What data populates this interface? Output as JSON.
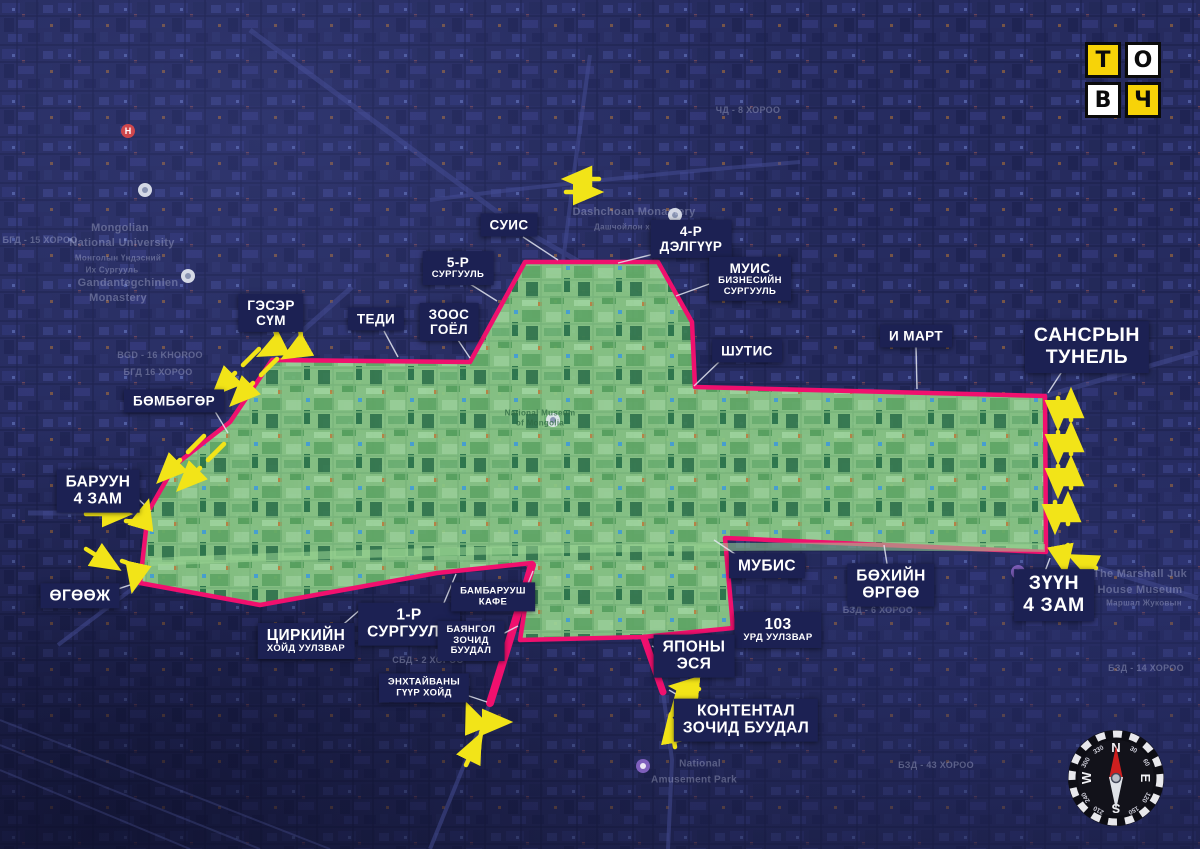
{
  "page": {
    "width": 1200,
    "height": 849,
    "kind": "annotated satellite map"
  },
  "colors": {
    "background": "#232858",
    "zone_fill": "#8ccb86",
    "zone_boundary": "#f0106e",
    "arrow_yellow": "#f2e418",
    "label_bg": "#1c2153",
    "label_text": "#ffffff",
    "logo_yellow": "#f7d308"
  },
  "logo": {
    "tiles": [
      {
        "ch": "Т",
        "bg": "#f7d308"
      },
      {
        "ch": "О",
        "bg": "#ffffff"
      },
      {
        "ch": "В",
        "bg": "#ffffff"
      },
      {
        "ch": "Ч",
        "bg": "#f7d308"
      }
    ]
  },
  "callouts": [
    {
      "id": "suis",
      "x": 509,
      "y": 225,
      "lines": [
        {
          "t": "СУИС",
          "s": "md"
        }
      ],
      "ptr": [
        523,
        237,
        558,
        260
      ]
    },
    {
      "id": "delguur-4",
      "x": 691,
      "y": 239,
      "lines": [
        {
          "t": "4-Р",
          "s": "md"
        },
        {
          "t": "ДЭЛГҮҮР",
          "s": "md"
        }
      ],
      "ptr": [
        662,
        252,
        618,
        263
      ]
    },
    {
      "id": "surguuli-5",
      "x": 458,
      "y": 268,
      "lines": [
        {
          "t": "5-Р",
          "s": "md"
        },
        {
          "t": "СУРГУУЛЬ",
          "s": "xxs"
        }
      ],
      "ptr": [
        470,
        284,
        497,
        301
      ]
    },
    {
      "id": "muis",
      "x": 750,
      "y": 279,
      "lines": [
        {
          "t": "МУИС",
          "s": "md"
        },
        {
          "t": "БИЗНЕСИЙН",
          "s": "xxs"
        },
        {
          "t": "СУРГУУЛЬ",
          "s": "xxs"
        }
      ],
      "ptr": [
        712,
        283,
        676,
        296
      ]
    },
    {
      "id": "zoos-goyol",
      "x": 449,
      "y": 322,
      "lines": [
        {
          "t": "ЗООС",
          "s": "md"
        },
        {
          "t": "ГОЁЛ",
          "s": "md"
        }
      ],
      "ptr": [
        458,
        340,
        470,
        358
      ]
    },
    {
      "id": "geser-sum",
      "x": 271,
      "y": 313,
      "lines": [
        {
          "t": "ГЭСЭР",
          "s": "md"
        },
        {
          "t": "СҮМ",
          "s": "md"
        }
      ],
      "ptr": [
        273,
        331,
        282,
        347
      ]
    },
    {
      "id": "tedi",
      "x": 376,
      "y": 319,
      "lines": [
        {
          "t": "ТЕДИ",
          "s": "md"
        }
      ],
      "ptr": [
        384,
        331,
        398,
        357
      ]
    },
    {
      "id": "shutis",
      "x": 747,
      "y": 351,
      "lines": [
        {
          "t": "ШУТИС",
          "s": "md"
        }
      ],
      "ptr": [
        720,
        361,
        694,
        386
      ]
    },
    {
      "id": "e-mart",
      "x": 916,
      "y": 336,
      "lines": [
        {
          "t": "И МАРТ",
          "s": "md"
        }
      ],
      "ptr": [
        916,
        347,
        917,
        389
      ]
    },
    {
      "id": "sansryn-tunel",
      "x": 1087,
      "y": 347,
      "lines": [
        {
          "t": "САНСРЫН",
          "s": "xl"
        },
        {
          "t": "ТУНЕЛЬ",
          "s": "xl"
        }
      ],
      "ptr": [
        1063,
        370,
        1048,
        393
      ]
    },
    {
      "id": "bombogor",
      "x": 174,
      "y": 401,
      "lines": [
        {
          "t": "БӨМБӨГӨР",
          "s": "md"
        }
      ],
      "ptr": [
        213,
        408,
        228,
        433
      ]
    },
    {
      "id": "baruun-4-zam",
      "x": 98,
      "y": 491,
      "lines": [
        {
          "t": "БАРУУН",
          "s": "lg"
        },
        {
          "t": "4 ЗАМ",
          "s": "lg"
        }
      ],
      "ptr": [
        134,
        495,
        151,
        511
      ]
    },
    {
      "id": "ogooj",
      "x": 80,
      "y": 596,
      "lines": [
        {
          "t": "ӨГӨӨЖ",
          "s": "lg"
        }
      ],
      "ptr": [
        103,
        594,
        136,
        583
      ]
    },
    {
      "id": "tsirkiin",
      "x": 306,
      "y": 641,
      "lines": [
        {
          "t": "ЦИРКИЙН",
          "s": "lg"
        },
        {
          "t": "ХОЙД УУЛЗВАР",
          "s": "xxs"
        }
      ],
      "ptr": [
        338,
        629,
        362,
        608
      ]
    },
    {
      "id": "surguuli-1",
      "x": 409,
      "y": 624,
      "lines": [
        {
          "t": "1-Р",
          "s": "lg"
        },
        {
          "t": "СУРГУУЛЬ",
          "s": "lg"
        }
      ],
      "ptr": [
        441,
        610,
        456,
        574
      ]
    },
    {
      "id": "bambaruush",
      "x": 493,
      "y": 597,
      "lines": [
        {
          "t": "БАМБАРУУШ",
          "s": "xxs"
        },
        {
          "t": "КАФЕ",
          "s": "xxs"
        }
      ],
      "ptr": [
        523,
        596,
        533,
        571
      ]
    },
    {
      "id": "bayangol",
      "x": 471,
      "y": 641,
      "lines": [
        {
          "t": "БАЯНГОЛ",
          "s": "xxs"
        },
        {
          "t": "ЗОЧИД",
          "s": "xxs"
        },
        {
          "t": "БУУДАЛ",
          "s": "xxs"
        }
      ],
      "ptr": [
        495,
        638,
        518,
        626
      ]
    },
    {
      "id": "enkhtaivany",
      "x": 424,
      "y": 688,
      "lines": [
        {
          "t": "ЭНХТАЙВАНЫ",
          "s": "xxs"
        },
        {
          "t": "ГҮҮР ХОЙД",
          "s": "xxs"
        }
      ],
      "ptr": [
        454,
        691,
        487,
        702
      ]
    },
    {
      "id": "mubis",
      "x": 767,
      "y": 566,
      "lines": [
        {
          "t": "МУБИС",
          "s": "lg"
        }
      ],
      "ptr": [
        741,
        558,
        714,
        540
      ]
    },
    {
      "id": "bokhiin-orgoo",
      "x": 891,
      "y": 585,
      "lines": [
        {
          "t": "БӨХИЙН",
          "s": "lg"
        },
        {
          "t": "ӨРГӨӨ",
          "s": "lg"
        }
      ],
      "ptr": [
        888,
        570,
        884,
        545
      ]
    },
    {
      "id": "urd-103",
      "x": 778,
      "y": 630,
      "lines": [
        {
          "t": "103",
          "s": "lg"
        },
        {
          "t": "УРД УУЛЗВАР",
          "s": "xxs"
        }
      ],
      "ptr": [
        752,
        629,
        736,
        629
      ]
    },
    {
      "id": "yapony-esya",
      "x": 694,
      "y": 656,
      "lines": [
        {
          "t": "ЯПОНЫ",
          "s": "lg"
        },
        {
          "t": "ЭСЯ",
          "s": "lg"
        }
      ],
      "ptr": [
        666,
        653,
        652,
        646
      ]
    },
    {
      "id": "kontental",
      "x": 746,
      "y": 720,
      "lines": [
        {
          "t": "КОНТЕНТАЛ",
          "s": "lg"
        },
        {
          "t": "ЗОЧИД БУУДАЛ",
          "s": "lg"
        }
      ],
      "ptr": [
        698,
        707,
        669,
        690
      ]
    },
    {
      "id": "zuun-4-zam",
      "x": 1054,
      "y": 595,
      "lines": [
        {
          "t": "ЗҮҮН",
          "s": "xl"
        },
        {
          "t": "4 ЗАМ",
          "s": "xl"
        }
      ],
      "ptr": [
        1044,
        574,
        1050,
        558
      ]
    }
  ],
  "basemap_labels": [
    {
      "t": "Mongolian",
      "x": 120,
      "y": 228,
      "s": 11
    },
    {
      "t": "National University",
      "x": 122,
      "y": 243,
      "s": 11
    },
    {
      "t": "Монголын Үндэсний",
      "x": 118,
      "y": 258,
      "s": 8
    },
    {
      "t": "Их Сургууль",
      "x": 112,
      "y": 270,
      "s": 8
    },
    {
      "t": "Gandantegchinlen",
      "x": 128,
      "y": 283,
      "s": 11
    },
    {
      "t": "Monastery",
      "x": 118,
      "y": 298,
      "s": 11
    },
    {
      "t": "Dashchoan Monastery",
      "x": 634,
      "y": 212,
      "s": 11
    },
    {
      "t": "Дашчойлон хийд",
      "x": 630,
      "y": 227,
      "s": 8
    },
    {
      "t": "National Museum",
      "x": 540,
      "y": 413,
      "s": 8,
      "on": "green"
    },
    {
      "t": "of Mongolia",
      "x": 540,
      "y": 423,
      "s": 8,
      "on": "green"
    },
    {
      "t": "National",
      "x": 700,
      "y": 764,
      "s": 10
    },
    {
      "t": "Amusement Park",
      "x": 694,
      "y": 780,
      "s": 10
    },
    {
      "t": "The Marshall Juk",
      "x": 1140,
      "y": 574,
      "s": 11
    },
    {
      "t": "House Museum",
      "x": 1140,
      "y": 590,
      "s": 11
    },
    {
      "t": "Маршал Жуковын",
      "x": 1144,
      "y": 603,
      "s": 8
    },
    {
      "t": "BGD - 16 KHOROO",
      "x": 160,
      "y": 355,
      "s": 9
    },
    {
      "t": "БГД 16 ХОРОО",
      "x": 158,
      "y": 372,
      "s": 9
    },
    {
      "t": "СБД - 2 ХОРОО",
      "x": 428,
      "y": 660,
      "s": 9
    },
    {
      "t": "БЗД - 6 ХОРОО",
      "x": 878,
      "y": 610,
      "s": 9
    },
    {
      "t": "БЗД - 14 ХОРОО",
      "x": 1146,
      "y": 668,
      "s": 9
    },
    {
      "t": "ЧД - 8 ХОРОО",
      "x": 748,
      "y": 110,
      "s": 9
    },
    {
      "t": "БЗД - 43 ХОРОО",
      "x": 936,
      "y": 765,
      "s": 9
    },
    {
      "t": "БГД - 15 ХОРОО",
      "x": 40,
      "y": 240,
      "s": 9
    }
  ],
  "pins": [
    {
      "x": 128,
      "y": 131,
      "kind": "hospital",
      "glyph": "H"
    },
    {
      "x": 145,
      "y": 190,
      "kind": "poi",
      "glyph": ""
    },
    {
      "x": 188,
      "y": 276,
      "kind": "poi",
      "glyph": ""
    },
    {
      "x": 675,
      "y": 215,
      "kind": "poi",
      "glyph": ""
    },
    {
      "x": 553,
      "y": 420,
      "kind": "poi",
      "glyph": ""
    },
    {
      "x": 643,
      "y": 766,
      "kind": "park",
      "glyph": ""
    },
    {
      "x": 1018,
      "y": 572,
      "kind": "park",
      "glyph": ""
    }
  ],
  "compass": {
    "cardinals": {
      "n": "N",
      "e": "E",
      "s": "S",
      "w": "W"
    },
    "degrees": [
      30,
      60,
      120,
      150,
      210,
      240,
      300,
      330
    ]
  }
}
